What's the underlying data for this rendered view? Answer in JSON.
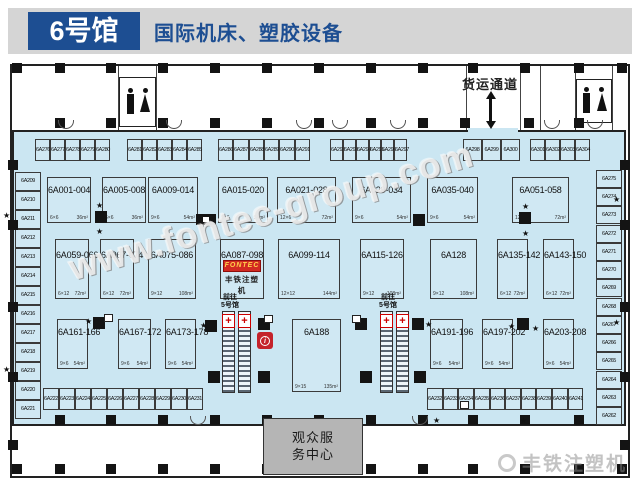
{
  "header": {
    "hall": "6号馆",
    "subtitle": "国际机床、塑胶设备"
  },
  "labels": {
    "freight": "货运通道",
    "to_hall5": [
      "前往",
      "5号馆"
    ],
    "service_center": "观众服务中心",
    "watermark": "www.fontec-group.com",
    "brand": "丰铁注塑机"
  },
  "brand": {
    "logo_text": "FONTEC",
    "logo_caption": "丰铁注塑机"
  },
  "colors": {
    "accent_blue": "#1d4e92",
    "floor_blue": "#cbe6f2",
    "service_gray": "#b5b5b5",
    "alert_red": "#c4232b",
    "logo_red": "#d22a22"
  },
  "booths": {
    "row1": [
      {
        "id": "6A001-004",
        "dim": "6×6",
        "area": "36m²",
        "x": 47,
        "w": 44
      },
      {
        "id": "6A005-008",
        "dim": "6×6",
        "area": "36m²",
        "x": 102,
        "w": 44
      },
      {
        "id": "6A009-014",
        "dim": "9×6",
        "area": "54m²",
        "x": 148,
        "w": 50
      },
      {
        "id": "6A015-020",
        "dim": "9×6",
        "area": "54m²",
        "x": 218,
        "w": 50
      },
      {
        "id": "6A021-028",
        "dim": "12×6",
        "area": "72m²",
        "x": 277,
        "w": 59
      },
      {
        "id": "6A029-034",
        "dim": "9×6",
        "area": "54m²",
        "x": 352,
        "w": 59
      },
      {
        "id": "6A035-040",
        "dim": "9×6",
        "area": "54m²",
        "x": 427,
        "w": 51
      },
      {
        "id": "6A051-058",
        "dim": "12×6",
        "area": "72m²",
        "x": 512,
        "w": 57
      }
    ],
    "row2": [
      {
        "id": "6A059-066",
        "dim": "6×12",
        "area": "72m²",
        "x": 55,
        "w": 34
      },
      {
        "id": "6A067-074",
        "dim": "6×12",
        "area": "72m²",
        "x": 100,
        "w": 34
      },
      {
        "id": "6A075-086",
        "dim": "9×12",
        "area": "108m²",
        "x": 148,
        "w": 48
      },
      {
        "id": "6A087-098",
        "dim": "",
        "area": "",
        "x": 220,
        "w": 44,
        "logo": true
      },
      {
        "id": "6A099-114",
        "dim": "12×12",
        "area": "144m²",
        "x": 278,
        "w": 62
      },
      {
        "id": "6A115-126",
        "dim": "9×12",
        "area": "108m²",
        "x": 360,
        "w": 44
      },
      {
        "id": "6A128",
        "dim": "9×12",
        "area": "108m²",
        "x": 430,
        "w": 47
      },
      {
        "id": "6A135-142",
        "dim": "6×12",
        "area": "72m²",
        "x": 497,
        "w": 31
      },
      {
        "id": "6A143-150",
        "dim": "6×12",
        "area": "72m²",
        "x": 543,
        "w": 31
      }
    ],
    "row3": [
      {
        "id": "6A161-166",
        "dim": "9×6",
        "area": "54m²",
        "x": 57,
        "w": 31
      },
      {
        "id": "6A167-172",
        "dim": "9×6",
        "area": "54m²",
        "x": 118,
        "w": 33
      },
      {
        "id": "6A173-178",
        "dim": "9×6",
        "area": "54m²",
        "x": 165,
        "w": 31
      },
      {
        "id": "6A188",
        "dim": "9×15",
        "area": "135m²",
        "x": 292,
        "w": 49,
        "h": 73
      },
      {
        "id": "6A191-196",
        "dim": "9×6",
        "area": "54m²",
        "x": 430,
        "w": 33
      },
      {
        "id": "6A197-202",
        "dim": "9×6",
        "area": "54m²",
        "x": 482,
        "w": 31
      },
      {
        "id": "6A203-208",
        "dim": "9×6",
        "area": "54m²",
        "x": 543,
        "w": 31
      }
    ],
    "top_row": [
      {
        "id": "6A276",
        "x": 35,
        "w": 15
      },
      {
        "id": "6A277",
        "x": 50,
        "w": 15
      },
      {
        "id": "6A278",
        "x": 65,
        "w": 15
      },
      {
        "id": "6A279",
        "x": 80,
        "w": 15
      },
      {
        "id": "6A280",
        "x": 95,
        "w": 15
      },
      {
        "id": "6A281",
        "x": 127,
        "w": 15
      },
      {
        "id": "6A282",
        "x": 142,
        "w": 15
      },
      {
        "id": "6A283",
        "x": 157,
        "w": 15
      },
      {
        "id": "6A284",
        "x": 172,
        "w": 15
      },
      {
        "id": "6A285",
        "x": 187,
        "w": 15
      },
      {
        "id": "6A286",
        "x": 218,
        "w": 15
      },
      {
        "id": "6A287",
        "x": 233,
        "w": 16
      },
      {
        "id": "6A288",
        "x": 249,
        "w": 15
      },
      {
        "id": "6A289",
        "x": 264,
        "w": 15
      },
      {
        "id": "6A290",
        "x": 279,
        "w": 16
      },
      {
        "id": "6A291",
        "x": 295,
        "w": 15
      },
      {
        "id": "6A292",
        "x": 330,
        "w": 13
      },
      {
        "id": "6A293",
        "x": 343,
        "w": 13
      },
      {
        "id": "6A294",
        "x": 356,
        "w": 13
      },
      {
        "id": "6A295",
        "x": 369,
        "w": 12
      },
      {
        "id": "6A296",
        "x": 381,
        "w": 13
      },
      {
        "id": "6A297",
        "x": 394,
        "w": 13
      },
      {
        "id": "6A298",
        "x": 463,
        "w": 19
      },
      {
        "id": "6A299",
        "x": 482,
        "w": 19
      },
      {
        "id": "6A300",
        "x": 501,
        "w": 19
      },
      {
        "id": "6A301",
        "x": 530,
        "w": 15
      },
      {
        "id": "6A302",
        "x": 545,
        "w": 15
      },
      {
        "id": "6A303",
        "x": 560,
        "w": 15
      },
      {
        "id": "6A304",
        "x": 575,
        "w": 15
      }
    ],
    "bottom_row": [
      {
        "id": "6A222",
        "x": 43,
        "w": 16
      },
      {
        "id": "6A223",
        "x": 59,
        "w": 16
      },
      {
        "id": "6A224",
        "x": 75,
        "w": 16
      },
      {
        "id": "6A225",
        "x": 91,
        "w": 16
      },
      {
        "id": "6A226",
        "x": 107,
        "w": 16
      },
      {
        "id": "6A227",
        "x": 123,
        "w": 16
      },
      {
        "id": "6A228",
        "x": 139,
        "w": 16
      },
      {
        "id": "6A229",
        "x": 155,
        "w": 16
      },
      {
        "id": "6A230",
        "x": 171,
        "w": 16
      },
      {
        "id": "6A231",
        "x": 187,
        "w": 16
      },
      {
        "id": "6A232",
        "x": 427,
        "w": 16
      },
      {
        "id": "6A233",
        "x": 443,
        "w": 15
      },
      {
        "id": "6A234",
        "x": 458,
        "w": 16
      },
      {
        "id": "6A235",
        "x": 474,
        "w": 16
      },
      {
        "id": "6A236",
        "x": 490,
        "w": 15
      },
      {
        "id": "6A237",
        "x": 505,
        "w": 16
      },
      {
        "id": "6A238",
        "x": 521,
        "w": 15
      },
      {
        "id": "6A239",
        "x": 536,
        "w": 16
      },
      {
        "id": "6A240",
        "x": 552,
        "w": 16
      },
      {
        "id": "6A241",
        "x": 568,
        "w": 15
      }
    ],
    "left_col": [
      {
        "id": "6A209",
        "y": 172
      },
      {
        "id": "6A210",
        "y": 191
      },
      {
        "id": "6A211",
        "y": 210
      },
      {
        "id": "6A212",
        "y": 229
      },
      {
        "id": "6A213",
        "y": 248
      },
      {
        "id": "6A214",
        "y": 267
      },
      {
        "id": "6A215",
        "y": 286
      },
      {
        "id": "6A216",
        "y": 305
      },
      {
        "id": "6A217",
        "y": 324
      },
      {
        "id": "6A218",
        "y": 343
      },
      {
        "id": "6A219",
        "y": 362
      },
      {
        "id": "6A220",
        "y": 381
      },
      {
        "id": "6A221",
        "y": 400
      }
    ],
    "right_col": [
      {
        "id": "6A275",
        "y": 170
      },
      {
        "id": "6A274",
        "y": 188
      },
      {
        "id": "6A273",
        "y": 206
      },
      {
        "id": "6A272",
        "y": 225
      },
      {
        "id": "6A271",
        "y": 243
      },
      {
        "id": "6A270",
        "y": 261
      },
      {
        "id": "6A269",
        "y": 279
      },
      {
        "id": "6A268",
        "y": 298
      },
      {
        "id": "6A267",
        "y": 316
      },
      {
        "id": "6A266",
        "y": 334
      },
      {
        "id": "6A265",
        "y": 352
      },
      {
        "id": "6A264",
        "y": 371
      },
      {
        "id": "6A263",
        "y": 389
      },
      {
        "id": "6A262",
        "y": 407
      }
    ]
  },
  "walls": [
    {
      "x": 118,
      "y": 66,
      "w": 1,
      "h": 64
    },
    {
      "x": 156,
      "y": 66,
      "w": 1,
      "h": 64
    },
    {
      "x": 466,
      "y": 66,
      "w": 1,
      "h": 64
    },
    {
      "x": 520,
      "y": 66,
      "w": 1,
      "h": 64
    },
    {
      "x": 540,
      "y": 66,
      "w": 1,
      "h": 64
    },
    {
      "x": 575,
      "y": 66,
      "w": 1,
      "h": 64
    },
    {
      "x": 612,
      "y": 66,
      "w": 1,
      "h": 64
    }
  ],
  "icons": [
    {
      "t": "pillar",
      "x": 12,
      "y": 63
    },
    {
      "t": "pillar",
      "x": 55,
      "y": 63
    },
    {
      "t": "pillar",
      "x": 106,
      "y": 63
    },
    {
      "t": "pillar",
      "x": 158,
      "y": 63
    },
    {
      "t": "pillar",
      "x": 210,
      "y": 63
    },
    {
      "t": "pillar",
      "x": 262,
      "y": 63
    },
    {
      "t": "pillar",
      "x": 314,
      "y": 63
    },
    {
      "t": "pillar",
      "x": 366,
      "y": 63
    },
    {
      "t": "pillar",
      "x": 418,
      "y": 63
    },
    {
      "t": "pillar",
      "x": 468,
      "y": 63
    },
    {
      "t": "pillar",
      "x": 520,
      "y": 63
    },
    {
      "t": "pillar",
      "x": 574,
      "y": 63
    },
    {
      "t": "pillar",
      "x": 617,
      "y": 63
    },
    {
      "t": "pillar",
      "x": 55,
      "y": 118
    },
    {
      "t": "pillar",
      "x": 106,
      "y": 118
    },
    {
      "t": "pillar",
      "x": 158,
      "y": 118
    },
    {
      "t": "pillar",
      "x": 210,
      "y": 118
    },
    {
      "t": "pillar",
      "x": 262,
      "y": 118
    },
    {
      "t": "pillar",
      "x": 314,
      "y": 118
    },
    {
      "t": "pillar",
      "x": 366,
      "y": 118
    },
    {
      "t": "pillar",
      "x": 418,
      "y": 118
    },
    {
      "t": "pillar",
      "x": 460,
      "y": 118
    },
    {
      "t": "pillar",
      "x": 524,
      "y": 118
    },
    {
      "t": "pillar",
      "x": 574,
      "y": 118
    },
    {
      "t": "pillar",
      "x": 55,
      "y": 415
    },
    {
      "t": "pillar",
      "x": 106,
      "y": 415
    },
    {
      "t": "pillar",
      "x": 158,
      "y": 415
    },
    {
      "t": "pillar",
      "x": 210,
      "y": 415
    },
    {
      "t": "pillar",
      "x": 262,
      "y": 415
    },
    {
      "t": "pillar",
      "x": 314,
      "y": 415
    },
    {
      "t": "pillar",
      "x": 366,
      "y": 415
    },
    {
      "t": "pillar",
      "x": 418,
      "y": 415
    },
    {
      "t": "pillar",
      "x": 468,
      "y": 415
    },
    {
      "t": "pillar",
      "x": 520,
      "y": 415
    },
    {
      "t": "pillar",
      "x": 574,
      "y": 415
    },
    {
      "t": "pillar",
      "x": 12,
      "y": 464
    },
    {
      "t": "pillar",
      "x": 55,
      "y": 464
    },
    {
      "t": "pillar",
      "x": 106,
      "y": 464
    },
    {
      "t": "pillar",
      "x": 158,
      "y": 464
    },
    {
      "t": "pillar",
      "x": 210,
      "y": 464
    },
    {
      "t": "pillar",
      "x": 262,
      "y": 464
    },
    {
      "t": "pillar",
      "x": 314,
      "y": 464
    },
    {
      "t": "pillar",
      "x": 366,
      "y": 464
    },
    {
      "t": "pillar",
      "x": 418,
      "y": 464
    },
    {
      "t": "pillar",
      "x": 468,
      "y": 464
    },
    {
      "t": "pillar",
      "x": 520,
      "y": 464
    },
    {
      "t": "pillar",
      "x": 574,
      "y": 464
    },
    {
      "t": "pillar",
      "x": 617,
      "y": 464
    },
    {
      "t": "pillar",
      "x": 8,
      "y": 160
    },
    {
      "t": "pillar",
      "x": 8,
      "y": 220
    },
    {
      "t": "pillar",
      "x": 8,
      "y": 302
    },
    {
      "t": "pillar",
      "x": 8,
      "y": 372
    },
    {
      "t": "pillar",
      "x": 8,
      "y": 440
    },
    {
      "t": "pillar",
      "x": 620,
      "y": 160
    },
    {
      "t": "pillar",
      "x": 620,
      "y": 220
    },
    {
      "t": "pillar",
      "x": 620,
      "y": 302
    },
    {
      "t": "pillar",
      "x": 620,
      "y": 372
    },
    {
      "t": "pillar",
      "x": 620,
      "y": 440
    },
    {
      "t": "sq",
      "x": 95,
      "y": 211
    },
    {
      "t": "sq",
      "x": 413,
      "y": 214
    },
    {
      "t": "sq",
      "x": 519,
      "y": 212
    },
    {
      "t": "sq",
      "x": 93,
      "y": 317
    },
    {
      "t": "sq",
      "x": 205,
      "y": 320
    },
    {
      "t": "sq",
      "x": 258,
      "y": 318
    },
    {
      "t": "sq",
      "x": 355,
      "y": 318
    },
    {
      "t": "sq",
      "x": 412,
      "y": 318
    },
    {
      "t": "sq",
      "x": 517,
      "y": 318
    },
    {
      "t": "sq",
      "x": 208,
      "y": 371
    },
    {
      "t": "sq",
      "x": 258,
      "y": 371
    },
    {
      "t": "sq",
      "x": 360,
      "y": 371
    },
    {
      "t": "sq",
      "x": 414,
      "y": 371
    },
    {
      "t": "cam",
      "x": 196,
      "y": 214
    },
    {
      "t": "star",
      "x": 96,
      "y": 202
    },
    {
      "t": "star",
      "x": 96,
      "y": 228
    },
    {
      "t": "star",
      "x": 522,
      "y": 203
    },
    {
      "t": "star",
      "x": 522,
      "y": 230
    },
    {
      "t": "star",
      "x": 85,
      "y": 318
    },
    {
      "t": "star",
      "x": 200,
      "y": 322
    },
    {
      "t": "star",
      "x": 425,
      "y": 321
    },
    {
      "t": "star",
      "x": 508,
      "y": 323
    },
    {
      "t": "star",
      "x": 532,
      "y": 325
    },
    {
      "t": "star",
      "x": 3,
      "y": 212
    },
    {
      "t": "star",
      "x": 3,
      "y": 366
    },
    {
      "t": "star",
      "x": 613,
      "y": 196
    },
    {
      "t": "star",
      "x": 613,
      "y": 319
    },
    {
      "t": "star",
      "x": 433,
      "y": 417
    },
    {
      "t": "star",
      "x": 520,
      "y": 417
    },
    {
      "t": "box",
      "x": 104,
      "y": 314
    },
    {
      "t": "box",
      "x": 264,
      "y": 315
    },
    {
      "t": "box",
      "x": 352,
      "y": 315
    },
    {
      "t": "box",
      "x": 460,
      "y": 401
    },
    {
      "t": "arc",
      "x": 58,
      "y": 120
    },
    {
      "t": "arc",
      "x": 166,
      "y": 120
    },
    {
      "t": "arc",
      "x": 296,
      "y": 120
    },
    {
      "t": "arc",
      "x": 332,
      "y": 120
    },
    {
      "t": "arc",
      "x": 390,
      "y": 120
    },
    {
      "t": "arc",
      "x": 544,
      "y": 120
    },
    {
      "t": "arc",
      "x": 587,
      "y": 120
    },
    {
      "t": "arc",
      "x": 190,
      "y": 416
    },
    {
      "t": "arc",
      "x": 412,
      "y": 416
    },
    {
      "t": "esc",
      "x": 222,
      "y": 311
    },
    {
      "t": "esc",
      "x": 238,
      "y": 311
    },
    {
      "t": "esc",
      "x": 380,
      "y": 311
    },
    {
      "t": "esc",
      "x": 396,
      "y": 311
    },
    {
      "t": "aid",
      "x": 222,
      "y": 314
    },
    {
      "t": "aid",
      "x": 238,
      "y": 314
    },
    {
      "t": "aid",
      "x": 380,
      "y": 314
    },
    {
      "t": "aid",
      "x": 396,
      "y": 314
    }
  ]
}
